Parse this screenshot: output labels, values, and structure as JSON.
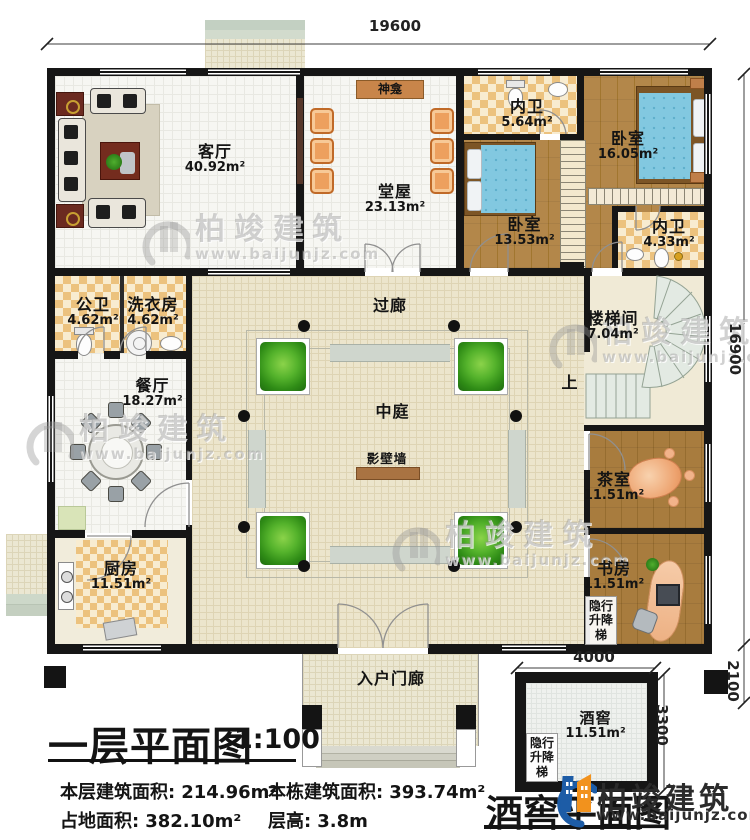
{
  "dims": {
    "width_top": "19600",
    "height_right": "16900",
    "cellar_width": "4000",
    "cellar_height": "3300",
    "porch_depth": "2100"
  },
  "rooms": {
    "living": {
      "name": "客厅",
      "area": "40.92m²"
    },
    "shrine": {
      "name": "神龛"
    },
    "hall": {
      "name": "堂屋",
      "area": "23.13m²"
    },
    "bath1": {
      "name": "内卫",
      "area": "5.64m²"
    },
    "bedroom1": {
      "name": "卧室",
      "area": "16.05m²"
    },
    "bedroom2": {
      "name": "卧室",
      "area": "13.53m²"
    },
    "bath2": {
      "name": "内卫",
      "area": "4.33m²"
    },
    "pubbath": {
      "name": "公卫",
      "area": "4.62m²"
    },
    "laundry": {
      "name": "洗衣房",
      "area": "4.62m²"
    },
    "corridor": {
      "name": "过廊"
    },
    "stair": {
      "name": "楼梯间",
      "area": "7.04m²"
    },
    "up": {
      "name": "上"
    },
    "dining": {
      "name": "餐厅",
      "area": "18.27m²"
    },
    "atrium": {
      "name": "中庭"
    },
    "screen": {
      "name": "影壁墙"
    },
    "tea": {
      "name": "茶室",
      "area": "11.51m²"
    },
    "kitchen": {
      "name": "厨房",
      "area": "11.51m²"
    },
    "study": {
      "name": "书房",
      "area": "11.51m²"
    },
    "lift": {
      "name": "隐行升降梯"
    },
    "porch": {
      "name": "入户门廊"
    },
    "cellar": {
      "name": "酒窖",
      "area": "11.51m²"
    }
  },
  "titleblock": {
    "title": "一层平面图",
    "scale": "1:100",
    "stats": [
      {
        "label": "本层建筑面积:",
        "value": "214.96m²"
      },
      {
        "label": "本栋建筑面积:",
        "value": "393.74m²"
      },
      {
        "label": "占地面积:",
        "value": "382.10m²"
      },
      {
        "label": "层高:",
        "value": "3.8m"
      }
    ],
    "cellar_title": "酒窖平面图"
  },
  "brand": {
    "name": "柏竣建筑",
    "url": "www.baijunjz.com"
  },
  "watermark": {
    "name": "柏竣建筑",
    "url": "www.baijunjz.com"
  },
  "colors": {
    "wall": "#161616",
    "wood_floor": "#ac7d3b",
    "tile_checker": "#e9c07a",
    "bed": "#7fc7e0",
    "chair": "#e8975c",
    "atrium_floor": "#ece5cc",
    "planter_green": "#3f9c22",
    "screen_wall": "#a97342",
    "brand_blue": "#1d5ca6",
    "brand_orange": "#f2921d"
  }
}
